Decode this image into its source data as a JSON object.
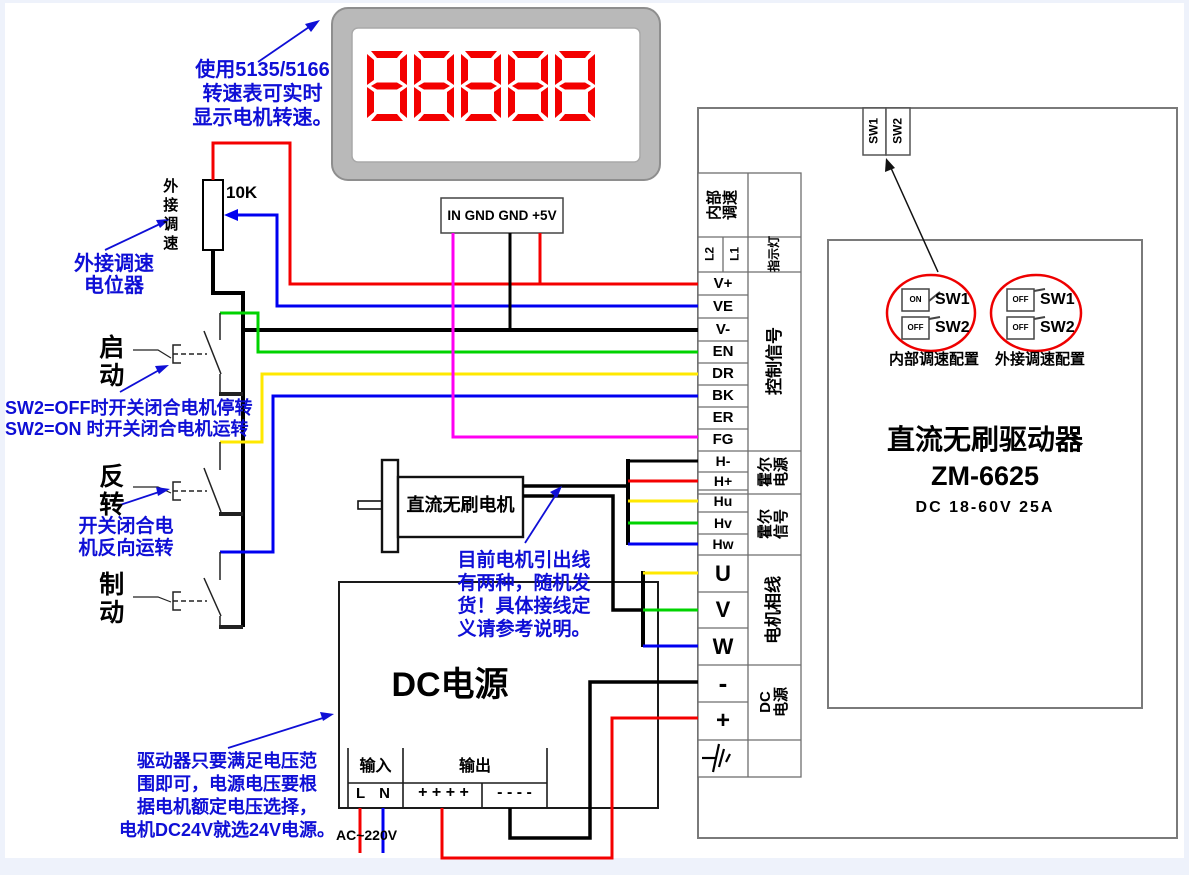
{
  "display": {
    "digits": "88888",
    "note": "使用5135/5166\n转速表可实时\n显示电机转速。"
  },
  "tach_connector": {
    "label": "IN GND GND +5V"
  },
  "pot": {
    "value": "10K",
    "vertical_label": "外接调速",
    "note": "外接调速\n电位器"
  },
  "switches": {
    "start": "启动",
    "reverse": "反转",
    "brake": "制动",
    "sw2_note": "SW2=OFF时开关闭合电机停转\nSW2=ON 时开关闭合电机运转",
    "reverse_note": "开关闭合电\n机反向运转"
  },
  "motor": {
    "label": "直流无刷电机",
    "note": "目前电机引出线\n有两种，随机发\n货！具体接线定\n义请参考说明。"
  },
  "power": {
    "title": "DC电源",
    "input": "输入",
    "output": "输出",
    "input_terminals": "L N",
    "output_plus": "+ + + +",
    "output_minus": "- - - -",
    "ac": "AC~220V",
    "note": "驱动器只要满足电压范\n围即可，电源电压要根\n据电机额定电压选择，\n电机DC24V就选24V电源。"
  },
  "driver": {
    "title": "直流无刷驱动器",
    "model": "ZM-6625",
    "spec": "DC 18-60V 25A",
    "dip_top": {
      "sw1": "SW1",
      "sw2": "SW2"
    },
    "config_internal": {
      "sw1_state": "ON",
      "sw2_state": "OFF",
      "sw1": "SW1",
      "sw2": "SW2",
      "label": "内部调速配置"
    },
    "config_external": {
      "sw1_state": "OFF",
      "sw2_state": "OFF",
      "sw1": "SW1",
      "sw2": "SW2",
      "label": "外接调速配置"
    }
  },
  "strip": {
    "groups": {
      "internal_speed": "内部\n调速",
      "l2": "L2",
      "l1": "L1",
      "indicator": "指示灯",
      "control": "控制信号",
      "hall_power": "霍尔\n电源",
      "hall_signal": "霍尔\n信号",
      "motor_phase": "电机相线",
      "dc_power": "DC\n电源"
    },
    "terminals": {
      "vplus": "V+",
      "ve": "VE",
      "vminus": "V-",
      "en": "EN",
      "dr": "DR",
      "bk": "BK",
      "er": "ER",
      "fg": "FG",
      "hminus": "H-",
      "hplus": "H+",
      "hu": "Hu",
      "hv": "Hv",
      "hw": "Hw",
      "u": "U",
      "v": "V",
      "w": "W",
      "minus": "-",
      "plus": "+"
    }
  },
  "colors": {
    "wire_red": "#f40000",
    "wire_blue": "#0000f0",
    "wire_green": "#00d300",
    "wire_yellow": "#ffe800",
    "wire_magenta": "#ff00f2",
    "annotation_blue": "#0f0fd6",
    "segment_red": "#f30000",
    "circle_red": "#ee0000",
    "frame_gray": "#b9b9b9"
  }
}
